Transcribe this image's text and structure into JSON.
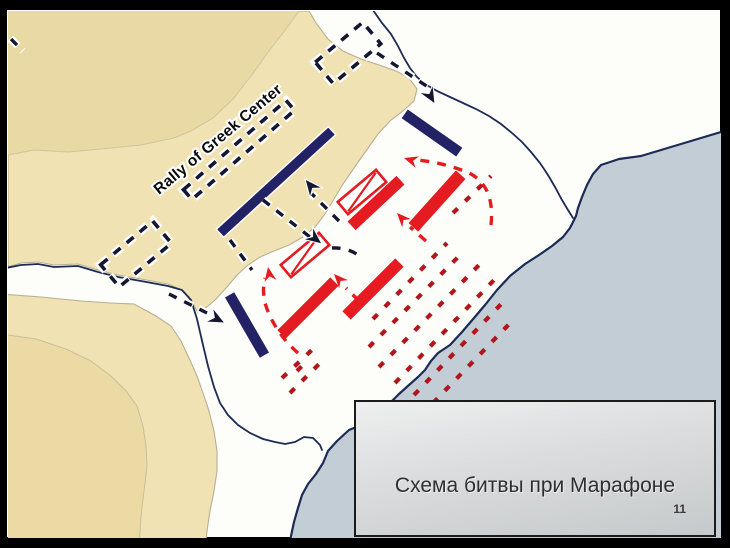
{
  "slide": {
    "caption_title": "Схема битвы при Марафоне",
    "page_number": "11"
  },
  "theme": {
    "frame": "#000000",
    "plain": "#fdfdfa",
    "land": "#f0e2b2",
    "land_dark": "#e9d9a5",
    "hill_inner": "#ebdaa4",
    "sea": "#c3cdd5",
    "coast": "#1c2b55",
    "greek": "#232264",
    "greek_dash": "#15172f",
    "persian": "#e41b20",
    "persian_dark": "#b2151b",
    "halo": "#ffffff",
    "caption_bg_top": "#efefef",
    "caption_bg_bottom": "#c6c9cb",
    "caption_border": "#1b1b1b",
    "caption_text": "#2f2f2f"
  },
  "map": {
    "labels": {
      "rally": "Rally of Greek Center"
    },
    "greek_bars": [
      {
        "id": "greek-line-main",
        "cx": 275,
        "cy": 181,
        "len": 152,
        "th": 11,
        "rot": -42.5
      },
      {
        "id": "greek-right-wing",
        "cx": 431,
        "cy": 132,
        "len": 68,
        "th": 12,
        "rot": 35
      },
      {
        "id": "greek-left-wing",
        "cx": 246,
        "cy": 324,
        "len": 71,
        "th": 12,
        "rot": 60
      }
    ],
    "greek_ghosts": [
      {
        "id": "greek-ghost-right",
        "cx": 347,
        "cy": 52,
        "len": 62,
        "th": 28,
        "rot": -40
      },
      {
        "id": "greek-ghost-center",
        "cx": 238,
        "cy": 149,
        "len": 136,
        "th": 13,
        "rot": -41
      },
      {
        "id": "greek-ghost-left",
        "cx": 135,
        "cy": 253,
        "len": 68,
        "th": 29,
        "rot": -40
      }
    ],
    "persian_bars": [
      {
        "id": "persian-line-1",
        "cx": 375,
        "cy": 202,
        "len": 68,
        "th": 13,
        "rot": -43
      },
      {
        "id": "persian-line-2",
        "cx": 436,
        "cy": 200,
        "len": 72,
        "th": 14,
        "rot": -48
      },
      {
        "id": "persian-line-3",
        "cx": 372,
        "cy": 288,
        "len": 76,
        "th": 13,
        "rot": -45
      },
      {
        "id": "persian-line-4",
        "cx": 307,
        "cy": 307,
        "len": 76,
        "th": 13,
        "rot": -45
      }
    ],
    "persian_cavalry": [
      {
        "id": "persian-cavalry-1",
        "cx": 361,
        "cy": 191,
        "len": 50,
        "th": 16,
        "rot": -40
      },
      {
        "id": "persian-cavalry-2",
        "cx": 304,
        "cy": 254,
        "len": 50,
        "th": 16,
        "rot": -40
      }
    ]
  }
}
